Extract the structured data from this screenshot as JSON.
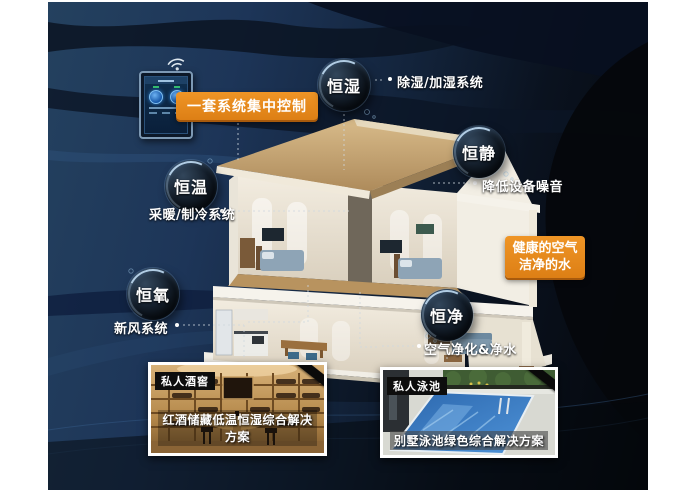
{
  "control": {
    "banner_label": "一套系统集中控制"
  },
  "highlight_box": {
    "line1": "健康的空气",
    "line2": "洁净的水"
  },
  "bubbles": [
    {
      "label": "恒湿",
      "sub_label": "除湿/加湿系统"
    },
    {
      "label": "恒静",
      "sub_label": "降低设备噪音"
    },
    {
      "label": "恒温",
      "sub_label": "采暖/制冷系统"
    },
    {
      "label": "恒氧",
      "sub_label": "新风系统"
    },
    {
      "label": "恒净",
      "sub_label": "空气净化&净水"
    }
  ],
  "photo_cards": [
    {
      "badge": "私人酒窖",
      "caption": "红酒储藏低温恒湿综合解决方案"
    },
    {
      "badge": "私人泳池",
      "caption": "别墅泳池绿色综合解决方案"
    }
  ],
  "icons": {
    "wifi": "wifi-icon"
  },
  "colors": {
    "accent_orange": "#E6871D",
    "panel_navy": "#1F3A5C",
    "panel_dark": "#06080D",
    "label_text": "#FFFFFF"
  }
}
